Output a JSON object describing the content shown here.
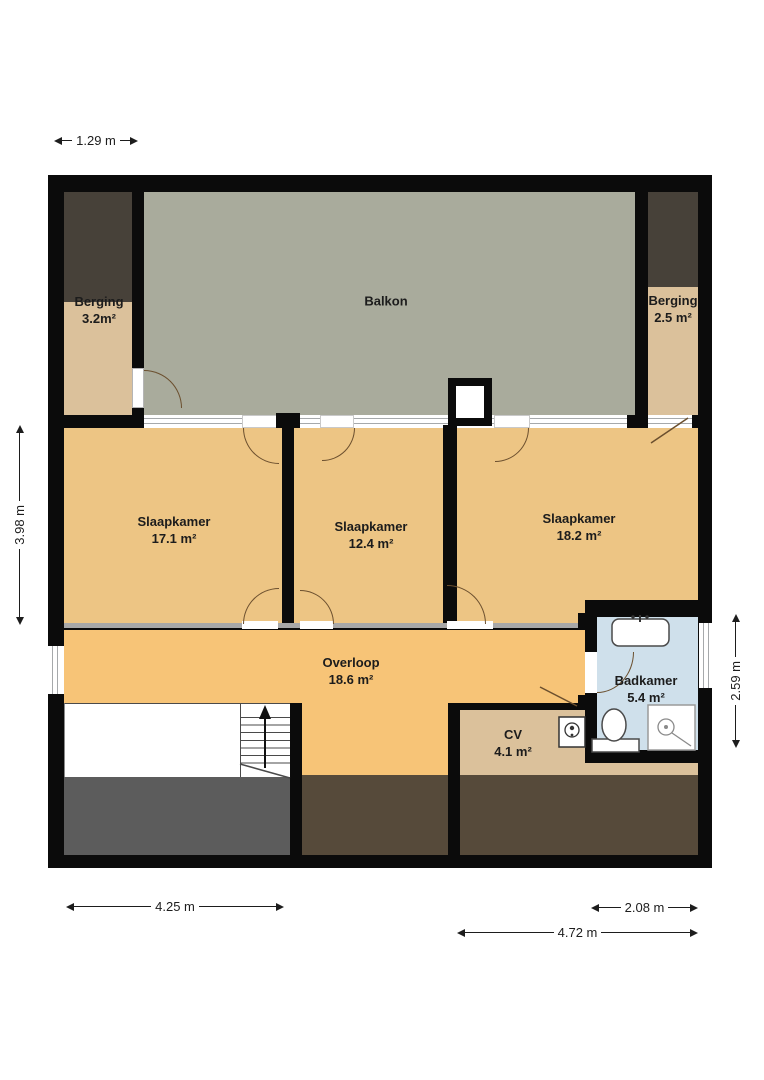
{
  "rooms": {
    "balkon": {
      "name": "Balkon"
    },
    "berging_left": {
      "name": "Berging",
      "area": "3.2m²"
    },
    "berging_right": {
      "name": "Berging",
      "area": "2.5 m²"
    },
    "slaapkamer_1": {
      "name": "Slaapkamer",
      "area": "17.1 m²"
    },
    "slaapkamer_2": {
      "name": "Slaapkamer",
      "area": "12.4 m²"
    },
    "slaapkamer_3": {
      "name": "Slaapkamer",
      "area": "18.2 m²"
    },
    "overloop": {
      "name": "Overloop",
      "area": "18.6 m²"
    },
    "badkamer": {
      "name": "Badkamer",
      "area": "5.4 m²"
    },
    "cv": {
      "name": "CV",
      "area": "4.1 m²"
    }
  },
  "dimensions": {
    "top_left_width": "1.29 m",
    "left_height": "3.98 m",
    "right_height": "2.59 m",
    "bottom_left_width": "4.25 m",
    "bottom_right_width": "2.08 m",
    "bottom_total_width": "4.72 m"
  },
  "colors": {
    "wall": "#0b0b0b",
    "balcony_floor": "#a9ab9c",
    "storage_floor": "#dbc19b",
    "bedroom_floor": "#edc584",
    "landing_floor": "#f7c477",
    "bathroom_floor": "#cfe0eb",
    "void_brown": "#564a3a",
    "void_gray": "#5c5c5c",
    "attic_dark": "#474139"
  }
}
